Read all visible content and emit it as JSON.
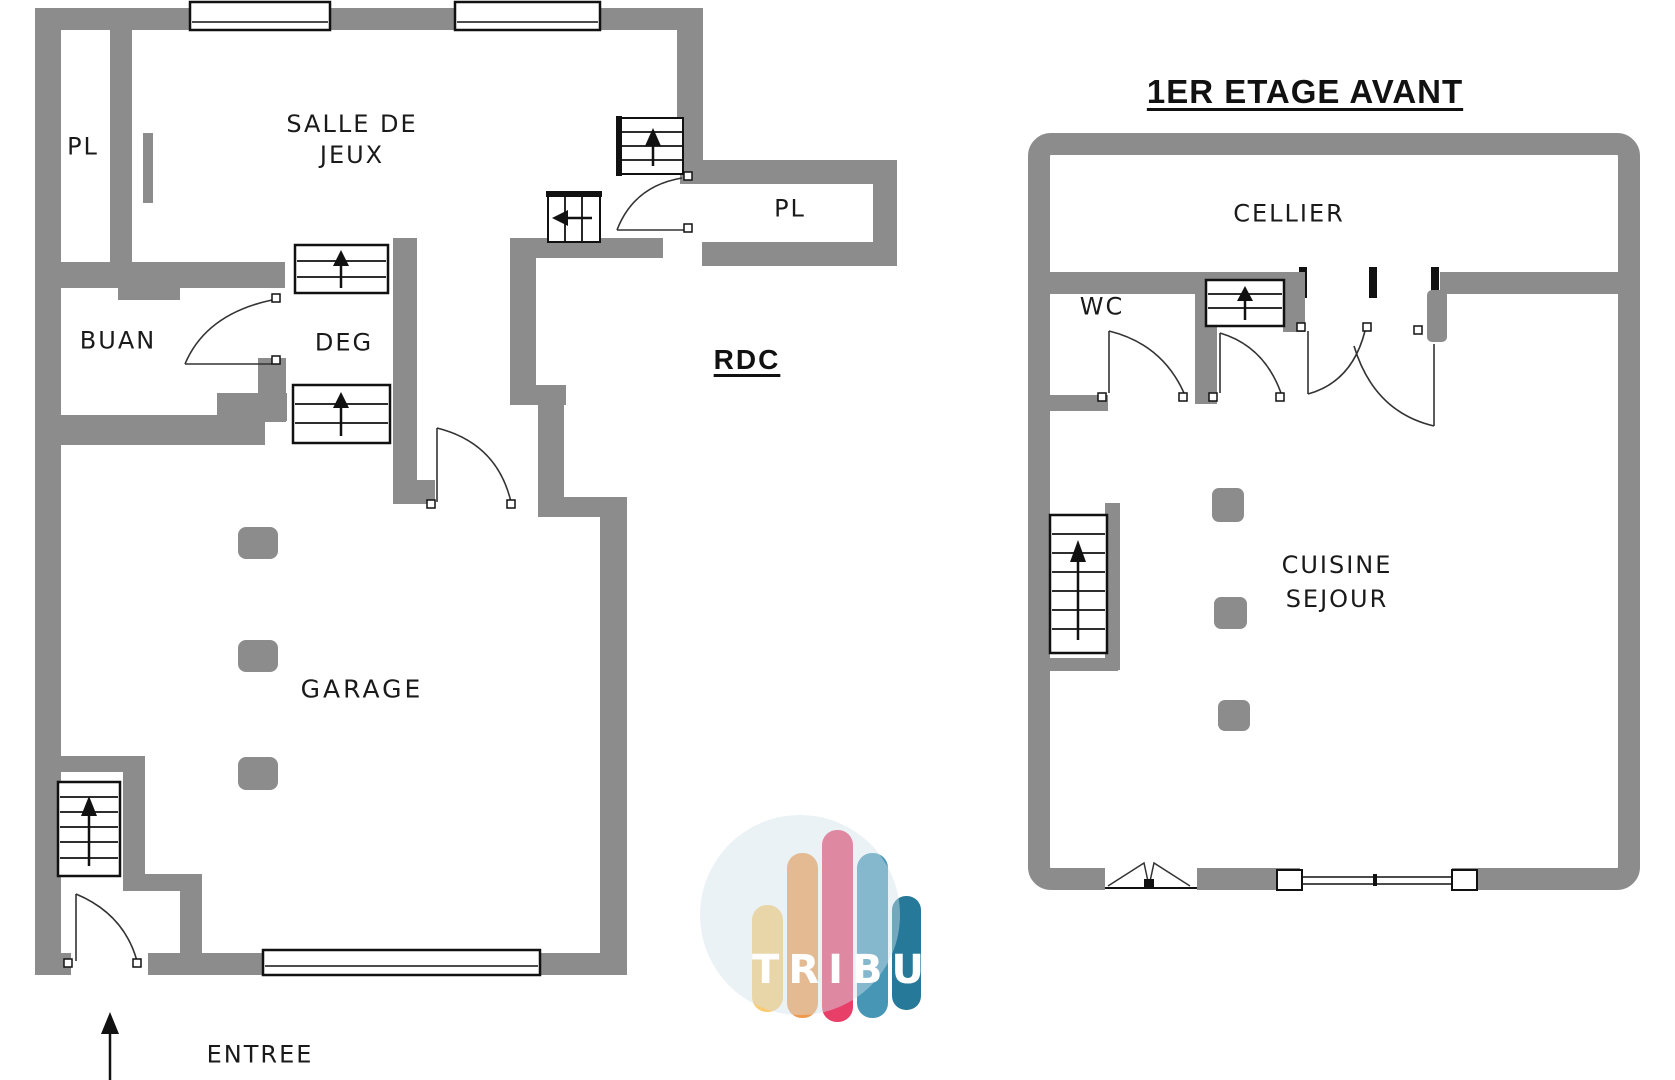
{
  "rdc": {
    "label": "RDC",
    "rooms": {
      "pl_closet": "PL",
      "salle_line1": "SALLE DE",
      "salle_line2": "JEUX",
      "buan": "BUAN",
      "deg": "DEG",
      "pl": "PL",
      "garage": "GARAGE"
    },
    "entrance_label": "ENTREE"
  },
  "etage": {
    "title": "1ER ETAGE AVANT",
    "rooms": {
      "cellier": "CELLIER",
      "wc": "WC",
      "cuisine_line1": "CUISINE",
      "cuisine_line2": "SEJOUR"
    }
  },
  "logo": {
    "text": "TRIBU"
  },
  "colors": {
    "wall": "#8C8C8C",
    "line": "#111111",
    "label": "#1A1A1A",
    "logo_bar_1": "#F9CB73",
    "logo_bar_2": "#F0994B",
    "logo_bar_3": "#E83F69",
    "logo_bar_4": "#4796B6",
    "logo_bar_5": "#27799A",
    "logo_circle": "#D3E2E9"
  },
  "icons": {
    "stairs": "stairs-icon",
    "door": "door-swing-icon",
    "window": "window-icon",
    "garage_door": "garage-door-icon",
    "sliding_door": "sliding-door-icon",
    "bifold_window": "bifold-window-icon",
    "pillar": "pillar-icon",
    "entrance_arrow": "entrance-arrow-icon"
  }
}
